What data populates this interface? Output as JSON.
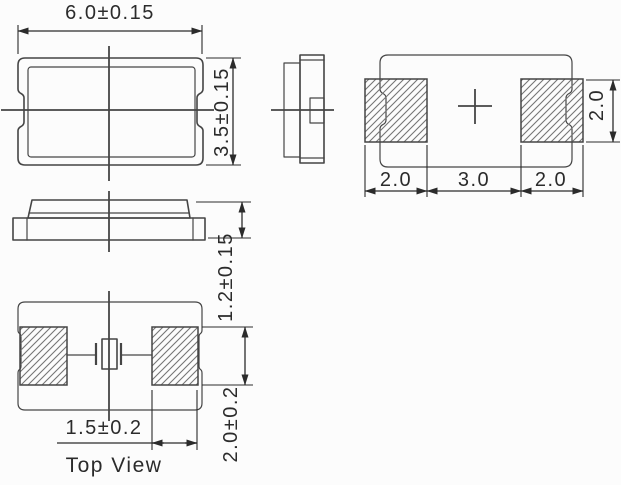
{
  "colors": {
    "background": "#fcfcfc",
    "line": "#454545",
    "dim": "#2b2b2b",
    "hatch": "#757575",
    "text": "#2b2b2b"
  },
  "labels": {
    "body_width": "6.0±0.15",
    "body_height": "3.5±0.15",
    "body_thickness": "1.2±0.15",
    "pad_left_width": "2.0",
    "pad_gap": "3.0",
    "pad_right_width": "2.0",
    "pad_height": "2.0",
    "electrode_width": "1.5±0.2",
    "electrode_height": "2.0±0.2",
    "view_title": "Top View"
  }
}
